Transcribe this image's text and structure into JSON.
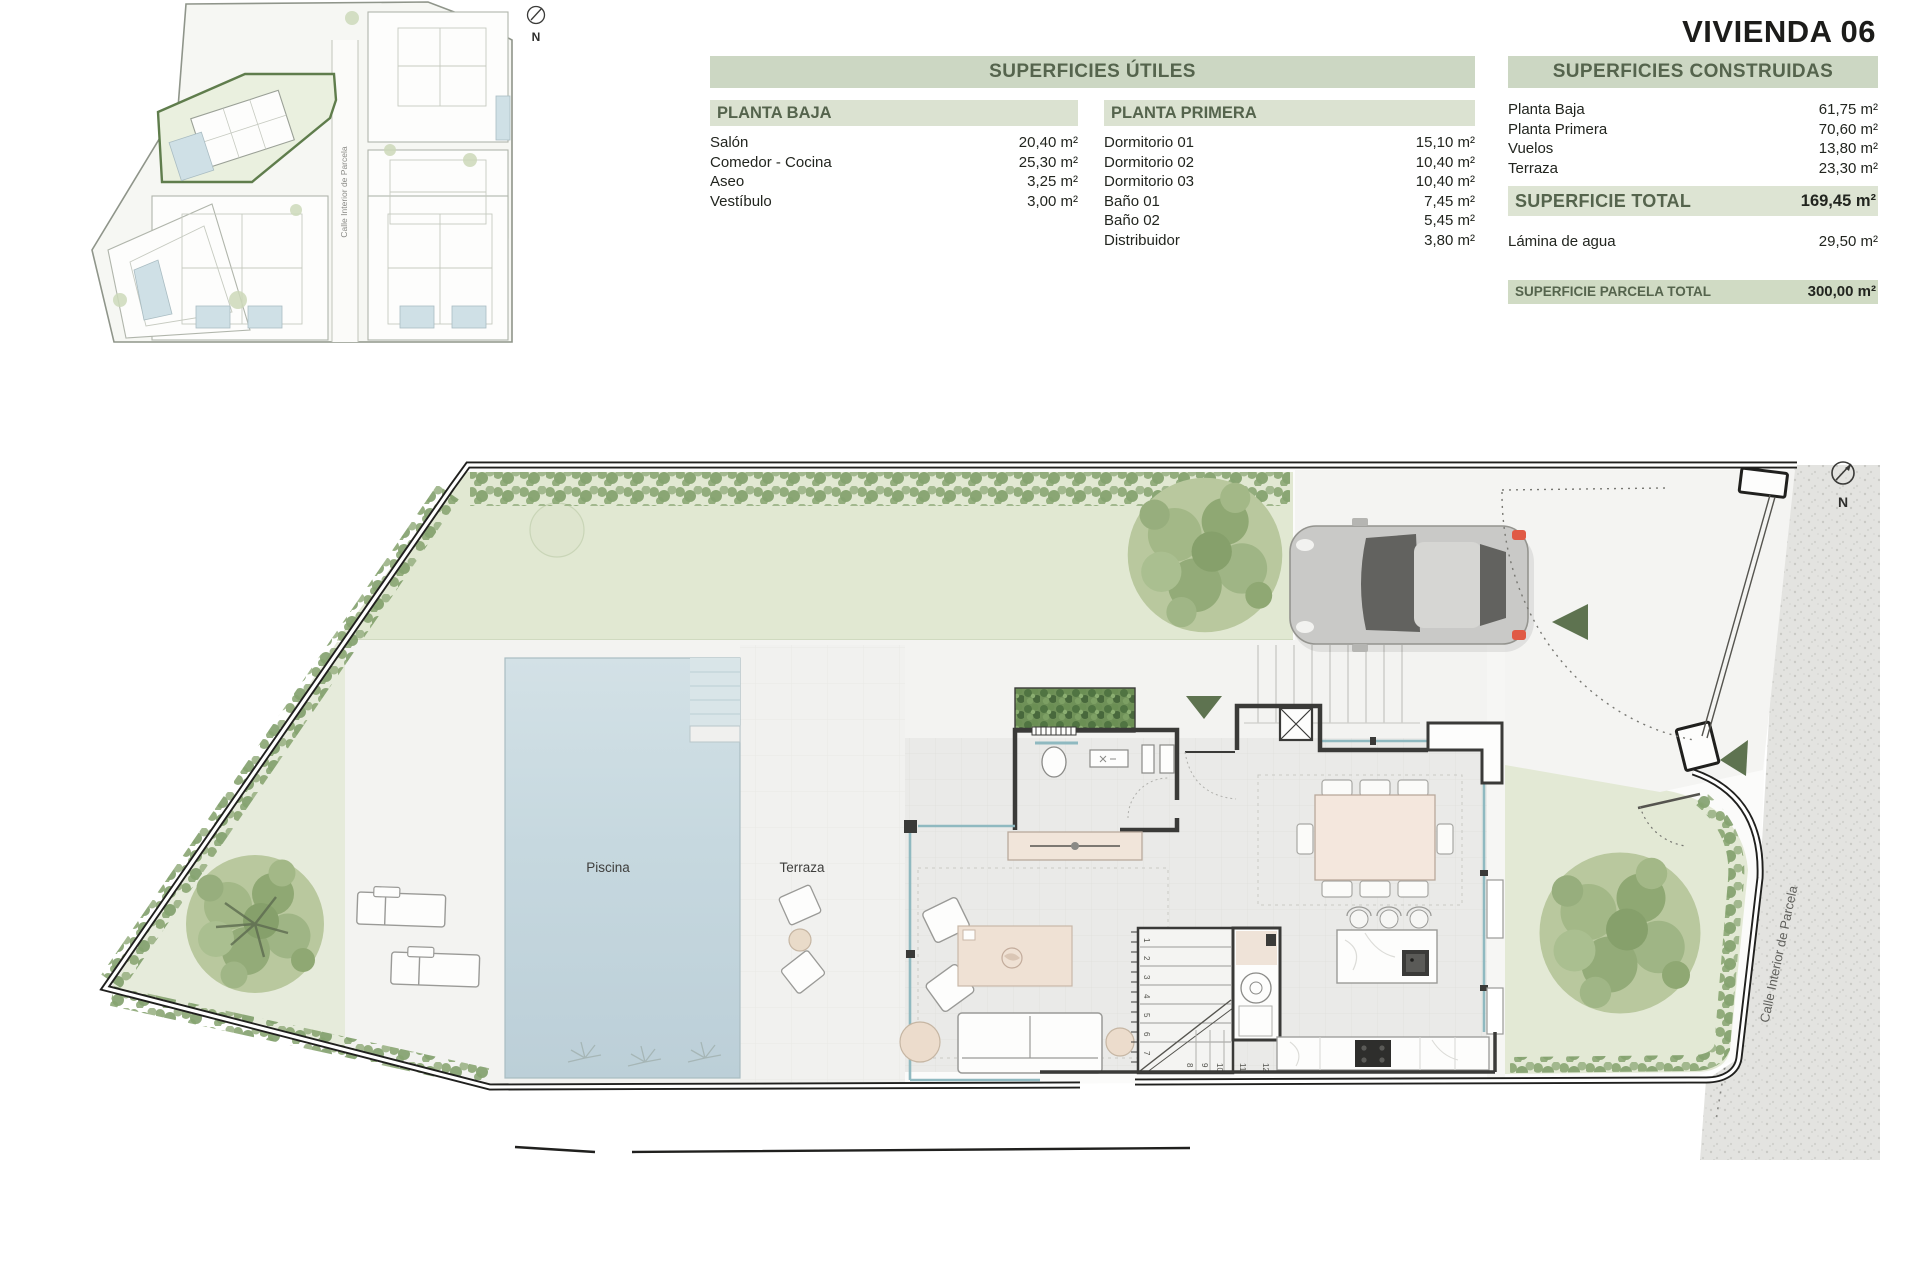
{
  "title": "VIVIENDA 06",
  "tables": {
    "utiles": {
      "header": "SUPERFICIES ÚTILES",
      "planta_baja": {
        "header": "PLANTA BAJA",
        "rows": [
          {
            "label": "Salón",
            "value": "20,40 m²"
          },
          {
            "label": "Comedor - Cocina",
            "value": "25,30 m²"
          },
          {
            "label": "Aseo",
            "value": "3,25 m²"
          },
          {
            "label": "Vestíbulo",
            "value": "3,00 m²"
          }
        ]
      },
      "planta_primera": {
        "header": "PLANTA PRIMERA",
        "rows": [
          {
            "label": "Dormitorio 01",
            "value": "15,10 m²"
          },
          {
            "label": "Dormitorio 02",
            "value": "10,40 m²"
          },
          {
            "label": "Dormitorio 03",
            "value": "10,40 m²"
          },
          {
            "label": "Baño 01",
            "value": "7,45 m²"
          },
          {
            "label": "Baño 02",
            "value": "5,45 m²"
          },
          {
            "label": "Distribuidor",
            "value": "3,80 m²"
          }
        ]
      }
    },
    "construidas": {
      "header": "SUPERFICIES CONSTRUIDAS",
      "rows": [
        {
          "label": "Planta Baja",
          "value": "61,75 m²"
        },
        {
          "label": "Planta Primera",
          "value": "70,60 m²"
        },
        {
          "label": "Vuelos",
          "value": "13,80 m²"
        },
        {
          "label": "Terraza",
          "value": "23,30 m²"
        }
      ],
      "total": {
        "label": "SUPERFICIE TOTAL",
        "value": "169,45 m²"
      },
      "lamina": {
        "label": "Lámina de agua",
        "value": "29,50 m²"
      },
      "parcela": {
        "label": "SUPERFICIE PARCELA TOTAL",
        "value": "300,00 m²"
      }
    }
  },
  "plan": {
    "pool_label": "Piscina",
    "terrace_label": "Terraza",
    "street_label": "Calle Interior de Parcela",
    "north_label": "N",
    "stairs": [
      "1",
      "2",
      "3",
      "4",
      "5",
      "6",
      "7",
      "8",
      "9",
      "10",
      "11",
      "12",
      "13",
      "14",
      "15",
      "16"
    ]
  },
  "site_plan": {
    "street_label": "Calle Interior de Parcela",
    "north_label": "N"
  },
  "colors": {
    "table_header_bg": "#ccd7c3",
    "table_subheader_bg": "#dbe2d1",
    "table_header_text": "#55644d",
    "highlight_parcel": "#5f7d4c",
    "pool_water": "#c6d8df",
    "grass": "#e1e8d2",
    "street": "#e3e3e0",
    "arrow_green": "#5e7350"
  }
}
